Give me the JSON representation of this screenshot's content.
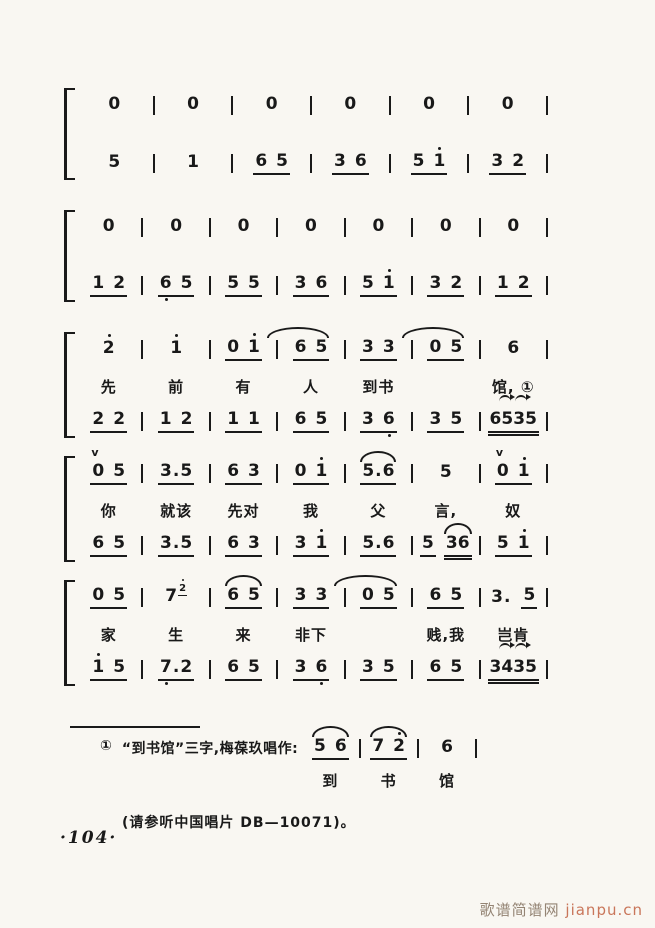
{
  "page": {
    "number": "·104·"
  },
  "watermark": {
    "cn": "歌谱简谱网",
    "en": "jianpu.cn"
  },
  "footnote": {
    "marker": "①",
    "text": "“到书馆”三字,梅葆玖唱作:",
    "record": "(请参听中国唱片 DB—10071)。",
    "score": {
      "notes": [
        [
          {
            "g": "5 6",
            "u": 1,
            "arc": "arc"
          }
        ],
        [
          {
            "g": "7 2'",
            "u": 1,
            "arc": "arc"
          }
        ],
        [
          {
            "g": "6"
          }
        ]
      ],
      "lyrics": [
        "到",
        "书",
        "馆"
      ]
    }
  },
  "systems": [
    {
      "tight": false,
      "lines": [
        {
          "type": "notes",
          "cells": [
            [
              {
                "g": "0"
              }
            ],
            [
              {
                "g": "0"
              }
            ],
            [
              {
                "g": "0"
              }
            ],
            [
              {
                "g": "0"
              }
            ],
            [
              {
                "g": "0"
              }
            ],
            [
              {
                "g": "0"
              }
            ]
          ]
        },
        {
          "type": "notes",
          "cells": [
            [
              {
                "g": "5"
              }
            ],
            [
              {
                "g": "1"
              }
            ],
            [
              {
                "g": "6 5",
                "u": 1
              }
            ],
            [
              {
                "g": "3 6",
                "u": 1
              }
            ],
            [
              {
                "g": "5 1'",
                "u": 1
              }
            ],
            [
              {
                "g": "3 2",
                "u": 1
              }
            ]
          ]
        }
      ]
    },
    {
      "tight": false,
      "lines": [
        {
          "type": "notes",
          "cells": [
            [
              {
                "g": "0"
              }
            ],
            [
              {
                "g": "0"
              }
            ],
            [
              {
                "g": "0"
              }
            ],
            [
              {
                "g": "0"
              }
            ],
            [
              {
                "g": "0"
              }
            ],
            [
              {
                "g": "0"
              }
            ],
            [
              {
                "g": "0"
              }
            ]
          ]
        },
        {
          "type": "notes",
          "cells": [
            [
              {
                "g": "1 2",
                "u": 1
              }
            ],
            [
              {
                "g": "6, 5",
                "u": 1
              }
            ],
            [
              {
                "g": "5 5",
                "u": 1
              }
            ],
            [
              {
                "g": "3 6",
                "u": 1
              }
            ],
            [
              {
                "g": "5 1'",
                "u": 1
              }
            ],
            [
              {
                "g": "3 2",
                "u": 1
              }
            ],
            [
              {
                "g": "1 2",
                "u": 1
              }
            ]
          ]
        }
      ]
    },
    {
      "tight": true,
      "lines": [
        {
          "type": "notes",
          "cells": [
            [
              {
                "g": "2'"
              }
            ],
            [
              {
                "g": "1'"
              }
            ],
            [
              {
                "g": "0 1'",
                "u": 1
              }
            ],
            [
              {
                "g": "6 5",
                "u": 1,
                "arc": "arcwide"
              }
            ],
            [
              {
                "g": "3 3",
                "u": 1
              }
            ],
            [
              {
                "g": "0 5",
                "u": 1,
                "arc": "arcwide"
              }
            ],
            [
              {
                "g": "6"
              }
            ]
          ]
        },
        {
          "type": "lyrics",
          "cells": [
            "先",
            "前",
            "有",
            "人",
            "到书",
            "",
            "馆, ①"
          ]
        },
        {
          "type": "notes",
          "cells": [
            [
              {
                "g": "2 2",
                "u": 1
              }
            ],
            [
              {
                "g": "1 2",
                "u": 1
              }
            ],
            [
              {
                "g": "1 1",
                "u": 1
              }
            ],
            [
              {
                "g": "6 5",
                "u": 1
              }
            ],
            [
              {
                "g": "3 6,",
                "u": 1
              }
            ],
            [
              {
                "g": "3 5",
                "u": 1
              }
            ],
            [
              {
                "g": "6535",
                "u": 2,
                "orn": "trem"
              }
            ]
          ]
        }
      ]
    },
    {
      "tight": true,
      "lines": [
        {
          "type": "notes",
          "cells": [
            [
              {
                "g": "0 5",
                "u": 1,
                "orn": "v"
              }
            ],
            [
              {
                "g": "3.5",
                "u": 1
              }
            ],
            [
              {
                "g": "6 3",
                "u": 1
              }
            ],
            [
              {
                "g": "0 1'",
                "u": 1
              }
            ],
            [
              {
                "g": "5.6",
                "u": 1,
                "arc": "arc"
              }
            ],
            [
              {
                "g": "5"
              }
            ],
            [
              {
                "g": "0 1'",
                "u": 1,
                "orn": "v"
              }
            ]
          ]
        },
        {
          "type": "lyrics",
          "cells": [
            "你",
            "就该",
            "先对",
            "我",
            "父",
            "言,",
            "奴"
          ]
        },
        {
          "type": "notes",
          "cells": [
            [
              {
                "g": "6 5",
                "u": 1
              }
            ],
            [
              {
                "g": "3.5",
                "u": 1
              }
            ],
            [
              {
                "g": "6 3",
                "u": 1
              }
            ],
            [
              {
                "g": "3 1'",
                "u": 1
              }
            ],
            [
              {
                "g": "5.6",
                "u": 1
              }
            ],
            [
              {
                "g": "5",
                "u": 1
              },
              {
                "g": "36",
                "u": 2,
                "arc": "arc"
              }
            ],
            [
              {
                "g": "5 1'",
                "u": 1
              }
            ]
          ]
        }
      ]
    },
    {
      "tight": true,
      "lines": [
        {
          "type": "notes",
          "cells": [
            [
              {
                "g": "0 5",
                "u": 1
              }
            ],
            [
              {
                "g": "7",
                "sup": "2'"
              }
            ],
            [
              {
                "g": "6 5",
                "u": 1,
                "arc": "arc"
              }
            ],
            [
              {
                "g": "3 3",
                "u": 1
              }
            ],
            [
              {
                "g": "0 5",
                "u": 1,
                "arc": "arcwide"
              }
            ],
            [
              {
                "g": "6 5",
                "u": 1
              }
            ],
            [
              {
                "g": "3."
              },
              {
                "g": "5",
                "u": 1
              }
            ]
          ]
        },
        {
          "type": "lyrics",
          "cells": [
            "家",
            "生",
            "来",
            "非下",
            "",
            "贱,我",
            "岂肯"
          ]
        },
        {
          "type": "notes",
          "cells": [
            [
              {
                "g": "1' 5",
                "u": 1
              }
            ],
            [
              {
                "g": "7,.2",
                "u": 1
              }
            ],
            [
              {
                "g": "6 5",
                "u": 1
              }
            ],
            [
              {
                "g": "3 6,",
                "u": 1
              }
            ],
            [
              {
                "g": "3 5",
                "u": 1
              }
            ],
            [
              {
                "g": "6 5",
                "u": 1
              }
            ],
            [
              {
                "g": "3435",
                "u": 2,
                "orn": "trem"
              }
            ]
          ]
        }
      ]
    }
  ]
}
